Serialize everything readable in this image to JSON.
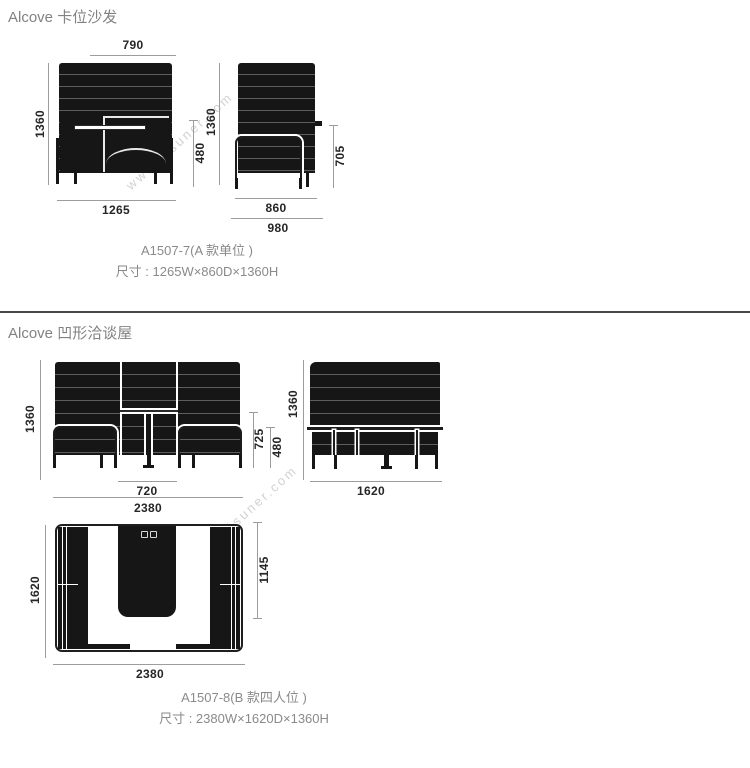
{
  "watermark": "www.insuner.com",
  "s1": {
    "heading": "Alcove 卡位沙发",
    "front": {
      "w_top": "790",
      "h_left": "1360",
      "h_seat": "480",
      "w_bottom": "1265"
    },
    "side": {
      "h_left": "1360",
      "h_right": "705",
      "d_inner": "860",
      "d_outer": "980"
    },
    "model": "A1507-7(A 款单位 )",
    "size": "尺寸 : 1265W×860D×1360H"
  },
  "s2": {
    "heading": "Alcove 凹形洽谈屋",
    "front": {
      "h_left": "1360",
      "h_arm": "725",
      "h_seat": "480",
      "w_table": "720",
      "w_bottom": "2380"
    },
    "side": {
      "h_left": "1360",
      "d_bottom": "1620"
    },
    "top": {
      "d_left": "1620",
      "d_right": "1145",
      "w_bottom": "2380"
    },
    "model": "A1507-8(B 款四人位 )",
    "size": "尺寸 : 2380W×1620D×1360H"
  }
}
